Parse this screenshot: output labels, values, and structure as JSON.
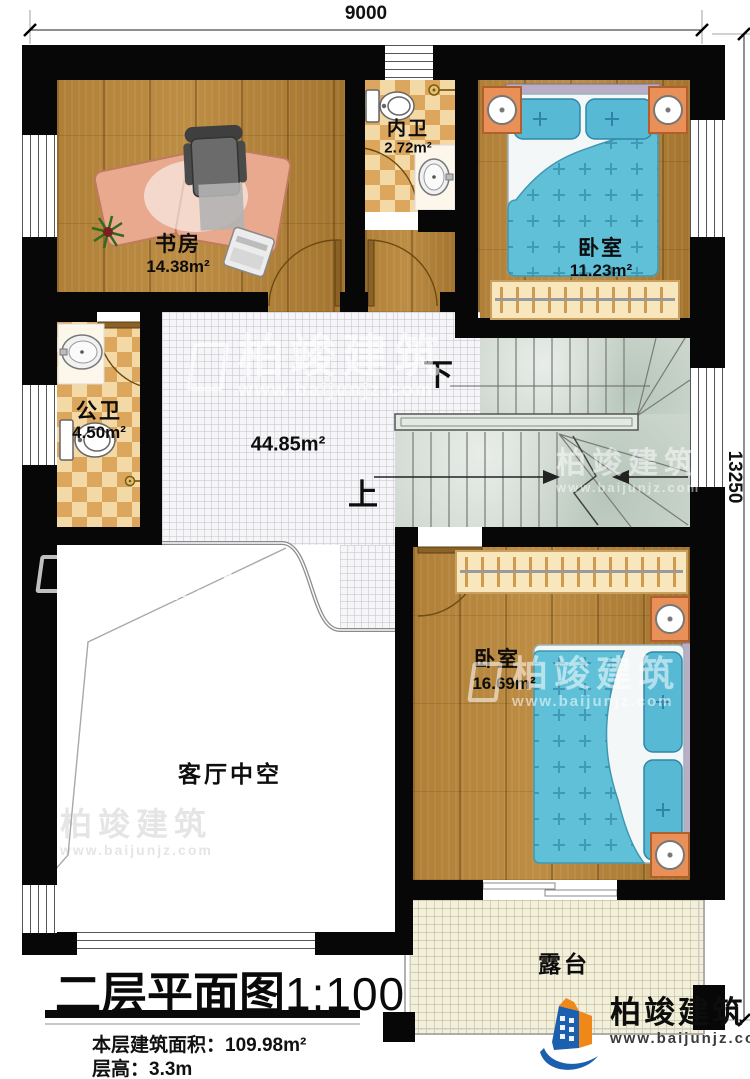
{
  "dimensions": {
    "width": "9000",
    "height": "13250"
  },
  "title": {
    "name": "二层平面图",
    "scale": "1:100"
  },
  "stats": {
    "area_label": "本层建筑面积：",
    "area_value": "109.98m²",
    "floor_height_label": "层高：",
    "floor_height_value": "3.3m"
  },
  "rooms": {
    "study": {
      "name": "书房",
      "area": "14.38m²"
    },
    "inner_bath": {
      "name": "内卫",
      "area": "2.72m²"
    },
    "bedroom1": {
      "name": "卧室",
      "area": "11.23m²"
    },
    "public_bath": {
      "name": "公卫",
      "area": "4.50m²"
    },
    "hall": {
      "area": "44.85m²"
    },
    "bedroom2": {
      "name": "卧室",
      "area": "16.69m²"
    },
    "living_void": {
      "name": "客厅中空"
    },
    "terrace": {
      "name": "露台"
    }
  },
  "stairs": {
    "up_label": "上",
    "down_label": "下"
  },
  "brand": {
    "name": "柏竣建筑",
    "url": "www.baijunjz.com"
  },
  "colors": {
    "wall": "#070707",
    "wood": "#ad7c33",
    "checker_dark": "#dca75c",
    "stair": "#cdd7ce",
    "terrace": "#f2efdb",
    "bed_blue": "#5fc0d8",
    "nightstand_orange": "#e89058",
    "brand_blue": "#1b5fae",
    "brand_orange": "#ef8818"
  }
}
